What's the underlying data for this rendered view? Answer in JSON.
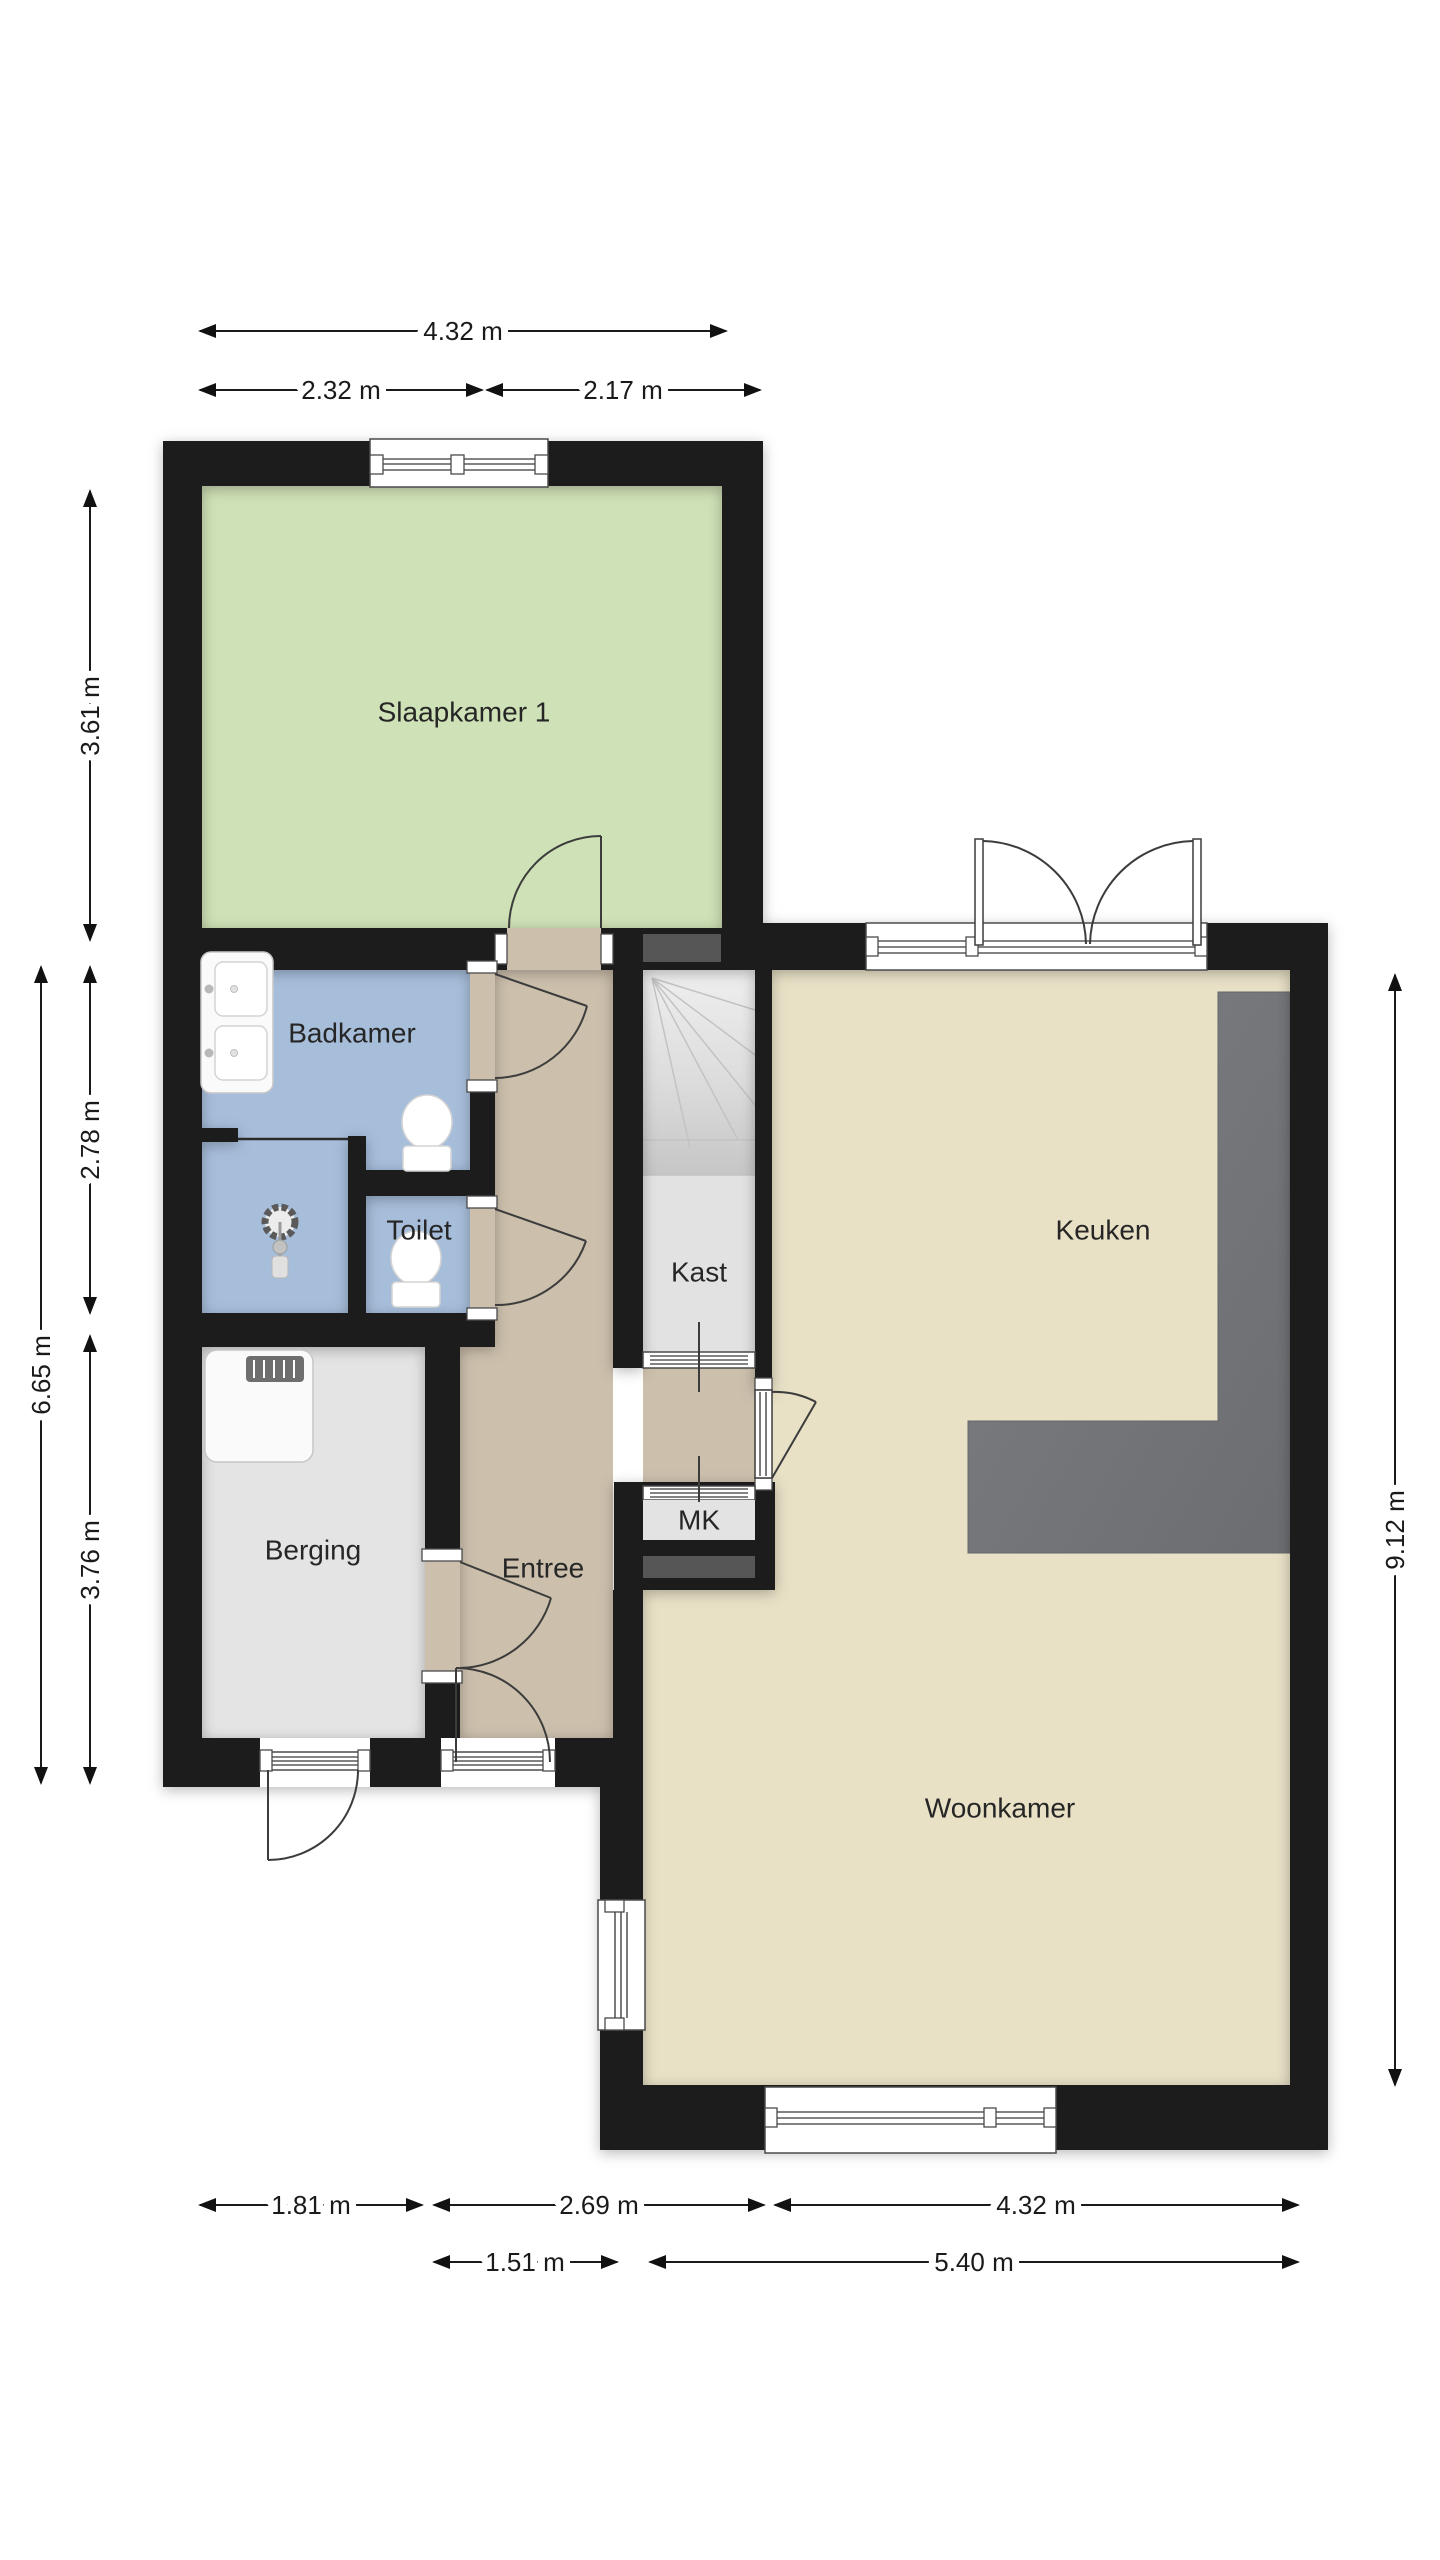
{
  "plan": {
    "rooms": [
      {
        "name": "slaapkamer-1",
        "label": "Slaapkamer 1"
      },
      {
        "name": "badkamer",
        "label": "Badkamer"
      },
      {
        "name": "toilet",
        "label": "Toilet"
      },
      {
        "name": "berging",
        "label": "Berging"
      },
      {
        "name": "entree",
        "label": "Entree"
      },
      {
        "name": "kast",
        "label": "Kast"
      },
      {
        "name": "mk",
        "label": "MK"
      },
      {
        "name": "keuken",
        "label": "Keuken"
      },
      {
        "name": "woonkamer",
        "label": "Woonkamer"
      }
    ],
    "dimensions": {
      "top": [
        "4.32 m",
        "2.32 m",
        "2.17 m"
      ],
      "left": [
        "3.61 m",
        "2.78 m",
        "3.76 m",
        "6.65 m"
      ],
      "right": [
        "9.12 m"
      ],
      "bottom": [
        "1.81 m",
        "2.69 m",
        "4.32 m",
        "1.51 m",
        "5.40 m"
      ]
    }
  },
  "colors": {
    "wall": "#1b1b1b",
    "bedroom": "#cfe1b6",
    "bath": "#a7bedb",
    "hall": "#ccbfac",
    "living": "#e8e1c6",
    "storage": "#e4e4e4",
    "counter": "#77797c",
    "niche": "#565656",
    "door_line": "#3c3c3c",
    "dim": "#1a1a1a"
  }
}
